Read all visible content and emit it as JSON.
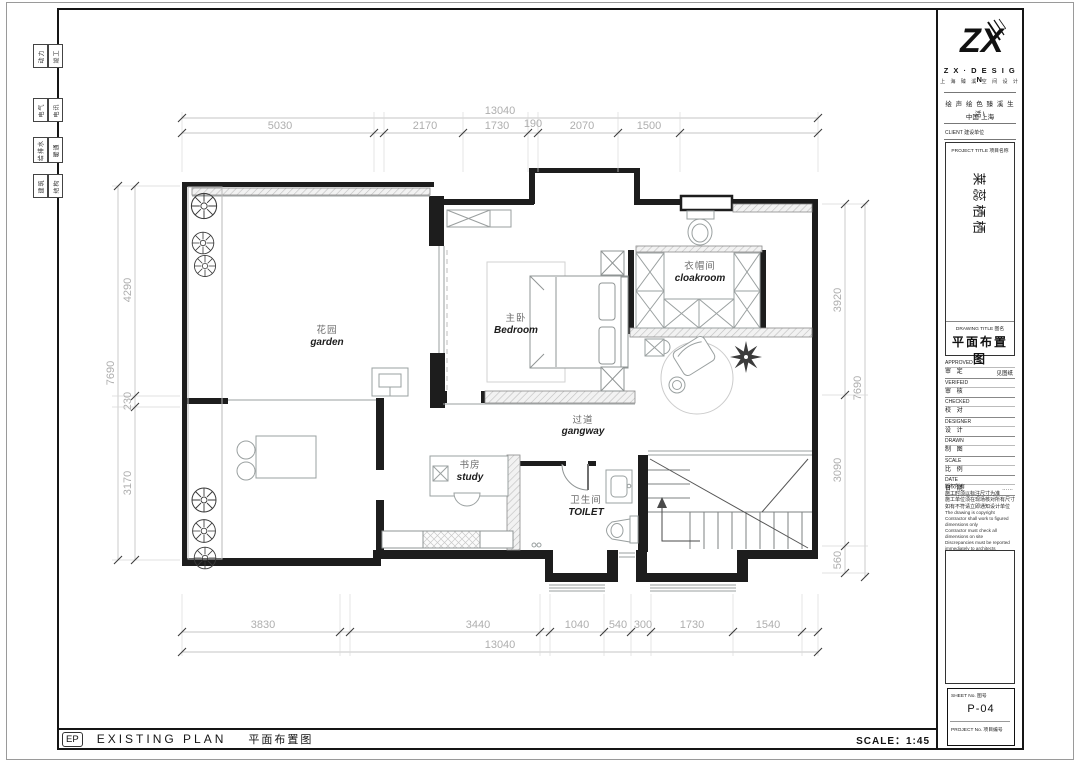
{
  "side_tabs": [
    {
      "a": "动力",
      "b": "竣工"
    },
    {
      "a": "电气",
      "b": "电讯"
    },
    {
      "a": "给排水",
      "b": "暖通"
    },
    {
      "a": "建筑",
      "b": "结构"
    }
  ],
  "title_block": {
    "logo_text": "ZX",
    "brand_en": "Z X · D E S I G N",
    "brand_cn": "上 海 臻 溪 空 间 设 计",
    "slogan": "绘 声 绘 色   臻 溪 生 活!",
    "location": "中国·上海",
    "client_label": "CLIENT  建设单位",
    "project_title_label": "PROJECT TITLE  项目名称",
    "project_name": "莱蕊栖栖",
    "drawing_title_label": "DRAWING TITLE  图名",
    "drawing_title": "平面布置图",
    "sign_rows": [
      {
        "en": "APPROVED",
        "cn": "审  定",
        "value": ""
      },
      {
        "en": "VERIFEID",
        "cn": "审  核",
        "value": ""
      },
      {
        "en": "CHECKED",
        "cn": "校  对",
        "value": ""
      },
      {
        "en": "DESIGNER",
        "cn": "设  计",
        "value": ""
      },
      {
        "en": "DRAWN",
        "cn": "制  图",
        "value": ""
      },
      {
        "en": "SCALE",
        "cn": "比  例",
        "value": "见图纸"
      },
      {
        "en": "DATE",
        "cn": "日  期",
        "value": "……"
      }
    ],
    "notes_cn": [
      "版权所有",
      "施工时须以标注尺寸为准",
      "施工单位须在现场核对所有尺寸",
      "如有不符请立即通知设计单位"
    ],
    "notes_en": [
      "The drawing is copyright",
      "Contractor shall work to figured dimensions only",
      "Contractor must check all dimensions on site",
      "Discrepancies must be reported immediately to architects"
    ],
    "sheet_no_label": "SHEET No.  图号",
    "sheet_no": "P-04",
    "project_no_label": "PROJECT No.  项目编号"
  },
  "footer": {
    "code": "EP",
    "title_en": "EXISTING PLAN",
    "title_cn": "平面布置图",
    "scale": "SCALE：1:45"
  },
  "plan": {
    "rooms": {
      "garden": {
        "cn": "花园",
        "en": "garden"
      },
      "bedroom": {
        "cn": "主卧",
        "en": "Bedroom"
      },
      "cloakroom": {
        "cn": "衣帽间",
        "en": "cloakroom"
      },
      "gangway": {
        "cn": "过道",
        "en": "gangway"
      },
      "study": {
        "cn": "书房",
        "en": "study"
      },
      "toilet": {
        "cn": "卫生间",
        "en": "TOILET"
      }
    },
    "dims": {
      "top_total": "13040",
      "top_segments": [
        "5030",
        "2170",
        "1730",
        "190",
        "2070",
        "1500"
      ],
      "left_total": "7690",
      "left_segments": [
        "4290",
        "230",
        "3170"
      ],
      "right_total": "7690",
      "right_segments": [
        "3920",
        "3090",
        "560"
      ],
      "bottom_total": "13040",
      "bottom_segments": [
        "3830",
        "3440",
        "1040",
        "540",
        "300",
        "1730",
        "1540"
      ]
    }
  }
}
